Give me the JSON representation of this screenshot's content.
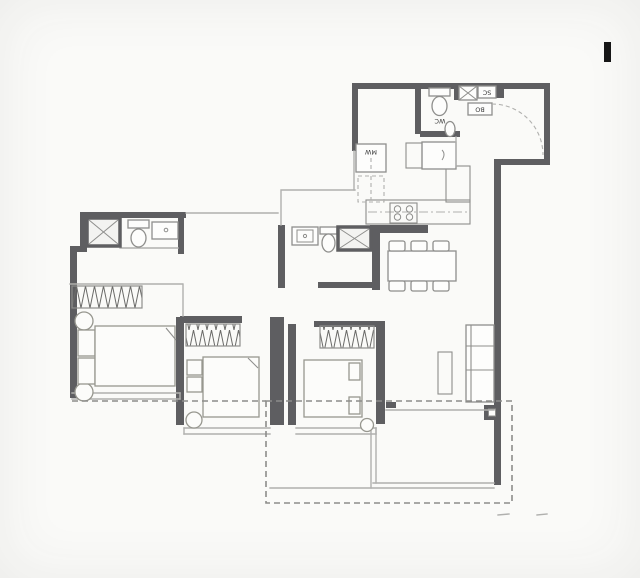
{
  "plan": {
    "labels": {
      "wc": "WC",
      "mw": "MW",
      "bo": "BO",
      "sc": "SC"
    },
    "colors": {
      "wall": "#5e5e61",
      "line": "#b0b0ae",
      "fixture": "#8e8e8c",
      "dash": "#8c8c8a",
      "label": "#3a3a3a",
      "mark": "#161616",
      "paper": "#fafaf8",
      "fill": "#fdfdfc"
    }
  }
}
